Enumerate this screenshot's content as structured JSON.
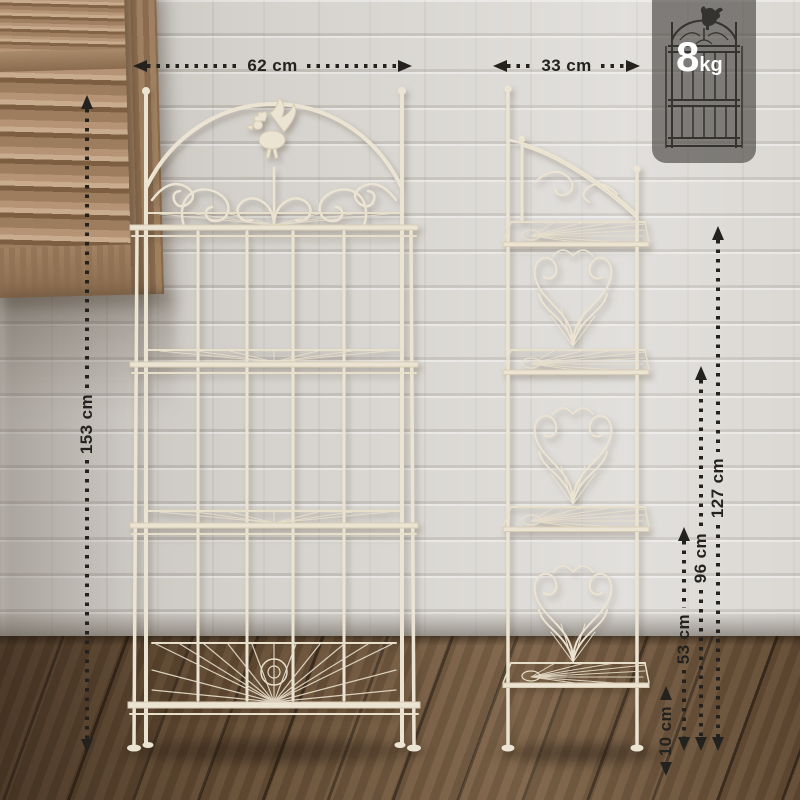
{
  "annotations": {
    "front_width": {
      "label": "62 cm",
      "value": 62,
      "unit": "cm"
    },
    "side_depth": {
      "label": "33 cm",
      "value": 33,
      "unit": "cm"
    },
    "total_height": {
      "label": "153 cm",
      "value": 153,
      "unit": "cm"
    },
    "shelf_heights": [
      {
        "label": "127 cm",
        "value": 127,
        "unit": "cm"
      },
      {
        "label": "96 cm",
        "value": 96,
        "unit": "cm"
      },
      {
        "label": "53 cm",
        "value": 53,
        "unit": "cm"
      },
      {
        "label": "10 cm",
        "value": 10,
        "unit": "cm"
      }
    ]
  },
  "weight_badge": {
    "value": "8",
    "unit": "kg"
  },
  "colors": {
    "annotation": "#24221f",
    "badge_background": "#423f3c",
    "badge_text": "#ffffff",
    "rack_metal": "#ece4d2",
    "wall": "#d5d2cd",
    "floor_wood": "#6a5138",
    "shutter_wood": "#a5866a"
  }
}
